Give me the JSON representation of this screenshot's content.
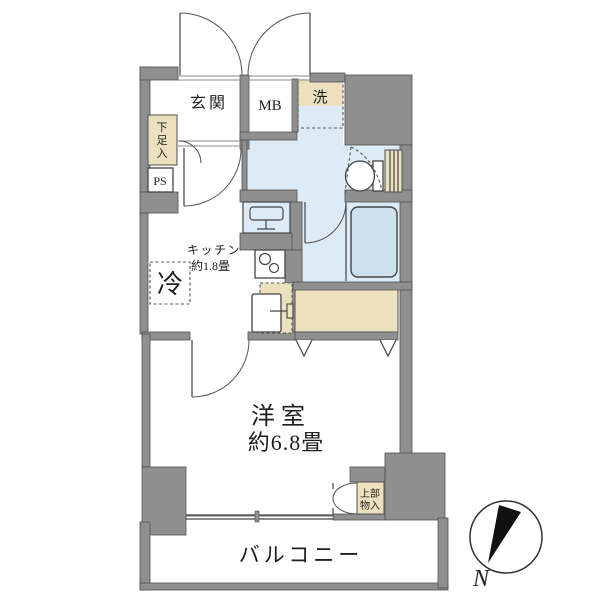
{
  "plan": {
    "type": "floor-plan",
    "labels": {
      "genkan": "玄関",
      "mb": "MB",
      "laundry": "洗",
      "shoe_chars": [
        "下",
        "足",
        "入"
      ],
      "ps": "PS",
      "fridge": "冷",
      "kitchen_name": "キッチン",
      "kitchen_size": "約1.8畳",
      "room_name": "洋室",
      "room_size": "約6.8畳",
      "upper_storage_line1": "上部",
      "upper_storage_line2": "物入",
      "balcony": "バルコニー",
      "compass_north": "N"
    },
    "colors": {
      "wall": "#8f8f8f",
      "wet_area": "#dcebf5",
      "bathtub": "#cde1ee",
      "fixture_beige": "#ece0bf",
      "outline": "#4a4a4a",
      "text": "#1f1f1f",
      "background": "#ffffff"
    }
  }
}
